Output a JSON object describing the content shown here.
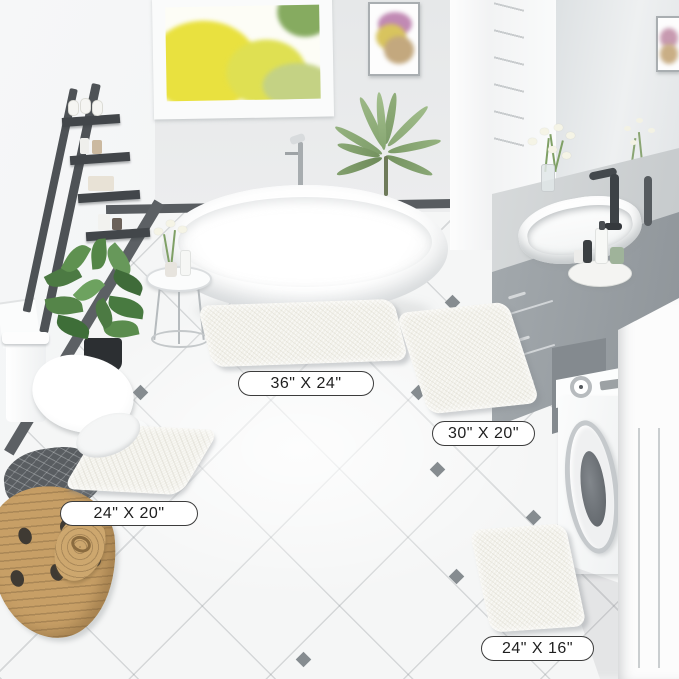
{
  "scene": {
    "subject": "bathroom with four-piece chenille bath mat set",
    "room_items": [
      "window",
      "wall-art",
      "ladder-shelf",
      "floor-plant",
      "palm-plant",
      "freestanding-bathtub",
      "floor-faucet",
      "side-table",
      "toilet",
      "laundry-basket",
      "vanity",
      "sink",
      "mirror",
      "washing-machine",
      "storage-cabinet"
    ]
  },
  "mats": [
    {
      "name": "large-rectangle-mat",
      "size_label": "36\" X 24\""
    },
    {
      "name": "runner-mat",
      "size_label": "30\" X 20\""
    },
    {
      "name": "contour-mat",
      "size_label": "24\" X 20\""
    },
    {
      "name": "small-rectangle-mat",
      "size_label": "24\" X 16\""
    }
  ],
  "colors": {
    "mat": "#f2f1ea",
    "floor": "#f5f6f6",
    "wall": "#e9ebec",
    "label_border": "#3c3c3c",
    "accent_dark": "#54585c",
    "vanity_gray": "#9aa0a5",
    "basket_tan": "#c79f66",
    "foliage_green": "#5d8a4e",
    "window_foliage_yellow": "#e9e13f"
  }
}
